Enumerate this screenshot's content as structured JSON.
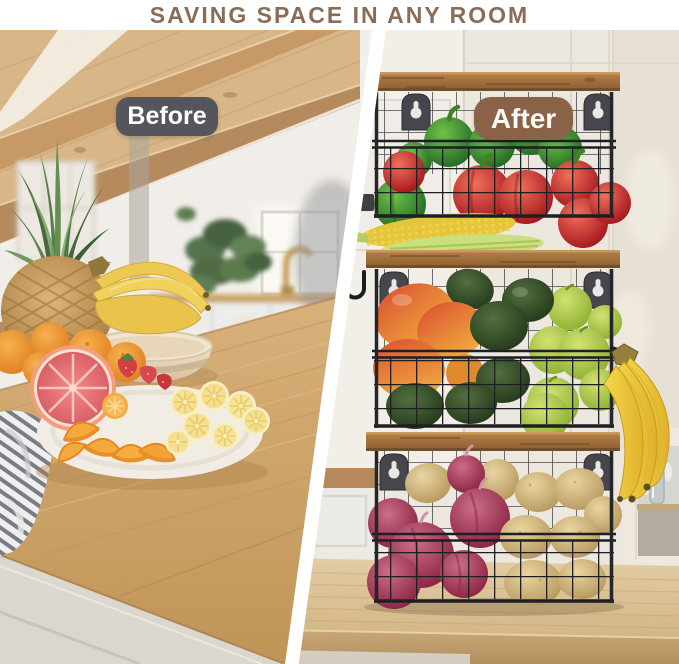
{
  "banner": {
    "title": "SAVING SPACE IN ANY ROOM",
    "text_color": "#8a6c57",
    "background": "#ffffff"
  },
  "divider": {
    "color": "#ffffff"
  },
  "before": {
    "label": "Before",
    "pill": {
      "background": "#55565b",
      "text_color": "#ffffff"
    },
    "scene": {
      "setting": "kitchen with wood-beam ceiling and window",
      "countertop_items": [
        "pineapple",
        "banana bunch in bowl",
        "whole oranges",
        "grapefruit half",
        "strawberries",
        "plate of orange wedges and lemon slices",
        "plate of tortilla wraps",
        "rolled wraps",
        "striped towel"
      ],
      "background_items": [
        "glass-front cabinet",
        "houseplant",
        "window",
        "brass faucet",
        "lower cabinets"
      ]
    }
  },
  "after": {
    "label": "After",
    "pill": {
      "background": "#8a6248",
      "text_color": "#fdf9f4"
    },
    "scene": {
      "setting": "kitchen counter against cream paneled wall",
      "product": "3-tier stackable wire baskets with wood lids and wall-mount brackets",
      "tiers": [
        {
          "name": "top",
          "contents": [
            "green bell peppers",
            "red bell peppers",
            "corn cobs"
          ]
        },
        {
          "name": "middle",
          "contents": [
            "mangoes",
            "avocados",
            "green apples"
          ]
        },
        {
          "name": "bottom",
          "contents": [
            "red onions",
            "potatoes"
          ]
        }
      ],
      "accessories": [
        "metal side hook",
        "banana bunch hanging on side hook"
      ],
      "background_items": [
        "upper cabinet",
        "open shelf with glass jar",
        "wood countertop"
      ]
    }
  }
}
